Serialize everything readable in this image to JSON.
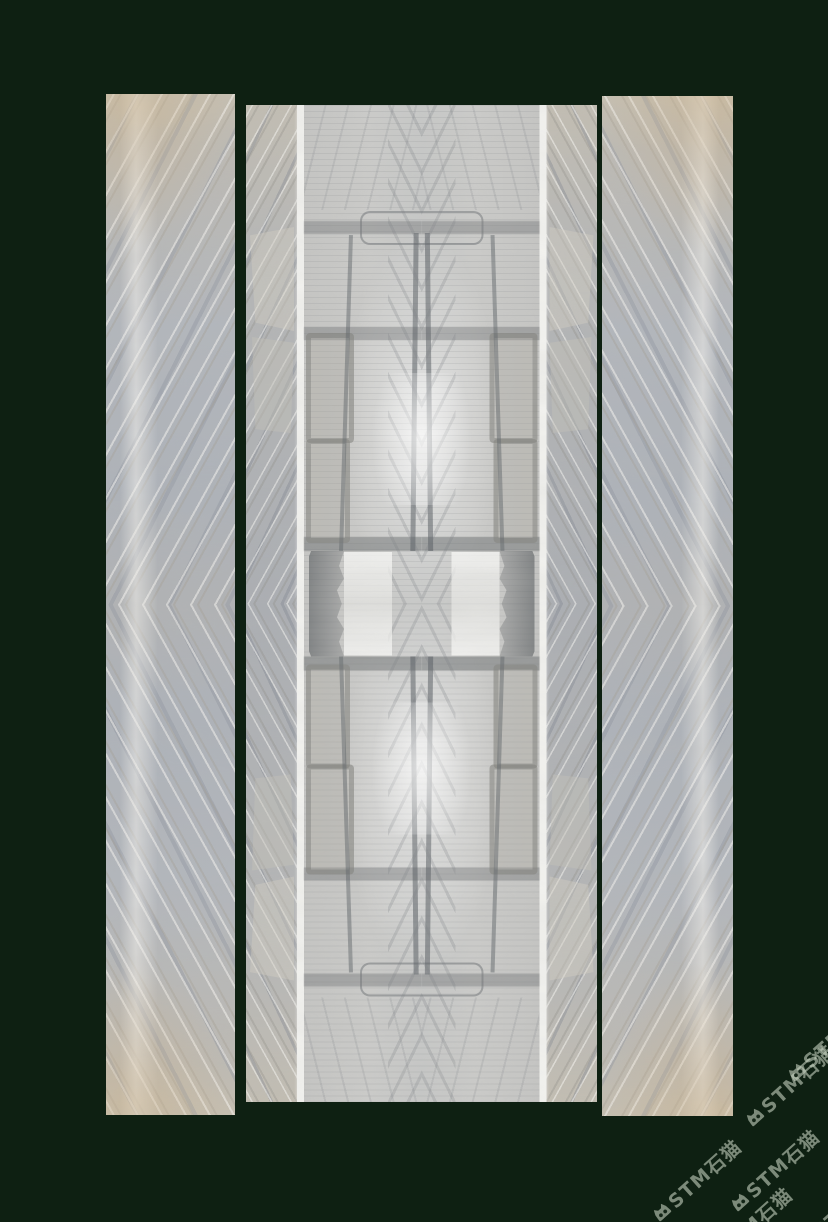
{
  "meta": {
    "description": "Product photo of three bookmatched grey-beige marble slab panels on a dark green background",
    "panel_count": 3
  },
  "colors": {
    "background": "#0e2012",
    "stripe_white": "#f3f3f0",
    "watermark": "rgba(198,210,192,0.6)",
    "marble_warm": "#c6bfb0",
    "marble_cool": "#adb2b9",
    "inner_light": "#cbcbc9"
  },
  "panels": {
    "left": {
      "label": "left marble slab"
    },
    "center": {
      "label": "center bookmatched marble slab with white light stripes"
    },
    "right": {
      "label": "right marble slab"
    }
  },
  "watermark": {
    "icon": "cat-logo-icon",
    "text": "STM石猫",
    "rotation_deg": -42,
    "instances": [
      {
        "x": 790,
        "y": 1085
      },
      {
        "x": 775,
        "y": 1170
      },
      {
        "x": 697,
        "y": 1180
      },
      {
        "x": 748,
        "y": 1228
      },
      {
        "x": 832,
        "y": 1040
      },
      {
        "x": 842,
        "y": 1210
      }
    ]
  }
}
